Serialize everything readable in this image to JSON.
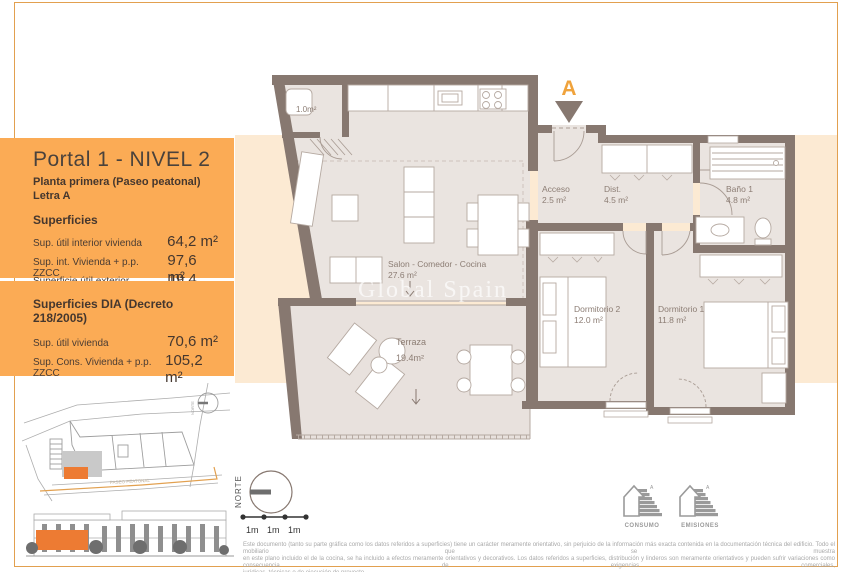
{
  "panel": {
    "title": "Portal 1 - NIVEL 2",
    "subtitle": "Planta primera (Paseo peatonal) Letra A",
    "superficies": {
      "heading": "Superficies",
      "rows": [
        {
          "label": "Sup. útil interior vivienda",
          "value": "64,2 m²"
        },
        {
          "label": "Sup. int. Vivienda + p.p. ZZCC",
          "value": "97,6 m²"
        },
        {
          "label": "Superficie útil exterior vivienda",
          "value": "19,4 m²"
        }
      ]
    },
    "superficies_dia": {
      "heading": "Superficies DIA (Decreto 218/2005)",
      "rows": [
        {
          "label": "Sup. útil vivienda",
          "value": "70,6 m²"
        },
        {
          "label": "Sup. Cons. Vivienda + p.p. ZZCC",
          "value": "105,2 m²"
        }
      ]
    }
  },
  "plan": {
    "unit_letter": "A",
    "watermark": "Global Spain",
    "rooms": {
      "trastero": {
        "area": "1.0m²"
      },
      "salon": {
        "name": "Salon - Comedor - Cocina",
        "area": "27.6 m²"
      },
      "terraza": {
        "name": "Terraza",
        "area": "19.4m²"
      },
      "acceso": {
        "name": "Acceso",
        "area": "2.5 m²"
      },
      "dist": {
        "name": "Dist.",
        "area": "4.5 m²"
      },
      "bano": {
        "name": "Baño 1",
        "area": "4.8 m²"
      },
      "dorm2": {
        "name": "Dormitorio 2",
        "area": "12.0 m²"
      },
      "dorm1": {
        "name": "Dormitorio 1",
        "area": "11.8 m²"
      }
    }
  },
  "sitemap": {
    "street_label": "PASEO PEATONAL",
    "north_label": "NORTE"
  },
  "compass": {
    "label": "NORTE"
  },
  "scalebar": {
    "labels": [
      "1m",
      "1m",
      "1m"
    ]
  },
  "energy": {
    "consumo_label": "CONSUMO",
    "emisiones_label": "EMISIONES",
    "grade": "A"
  },
  "disclaimer": {
    "line1": "Este documento (tanto su parte gráfica como los datos referidos a superficies) tiene un carácter meramente orientativo, sin perjuicio de la información más exacta contenida en la documentación técnica del edificio. Todo el mobiliario que se muestra",
    "line2": "en este plano incluido el de la cocina, se ha incluido a efectos meramente orientativos y decorativos. Los datos referidos a superficies, distribución y linderos son meramente orientativos y pueden sufrir variaciones como consecuencia de exigencias comerciales,",
    "line3": "jurídicas, técnicas o de ejecución de proyecto."
  },
  "colors": {
    "accent_orange": "#FBAB55",
    "frame_border": "#E2A04F",
    "peach_backdrop": "#FCEAD3",
    "wall_taupe": "#877870",
    "floor": "#EAE4E0",
    "highlight_orange": "#ED7B33",
    "marker_orange": "#F0A33C",
    "text_dark": "#45372E"
  }
}
